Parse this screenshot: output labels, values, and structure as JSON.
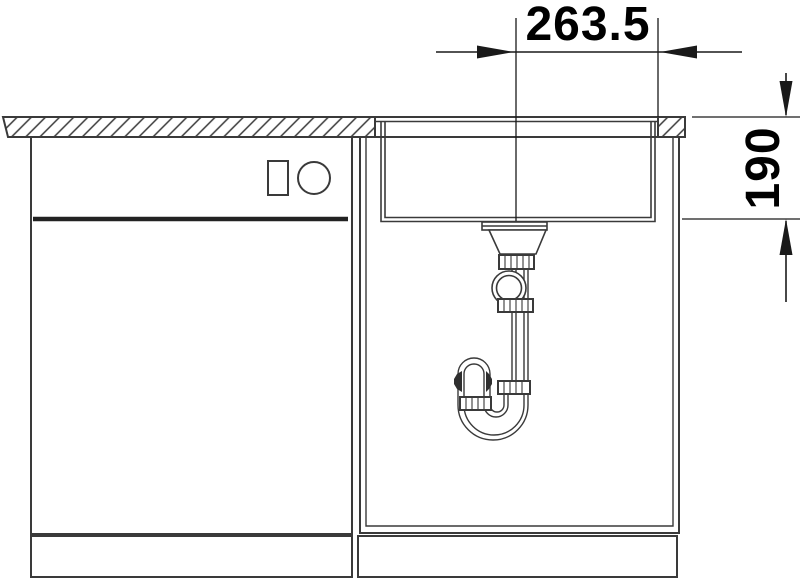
{
  "drawing": {
    "kind": "sink-installation-side-view",
    "dimensions": {
      "horizontal": {
        "label": "263.5"
      },
      "vertical": {
        "label": "190"
      }
    },
    "colors": {
      "line": "#3a3a3a",
      "dimension": "#1a1a1a",
      "text": "#000000",
      "background": "#ffffff",
      "thick_line": "#222222",
      "tab_fill": "#2f2f2f"
    }
  }
}
